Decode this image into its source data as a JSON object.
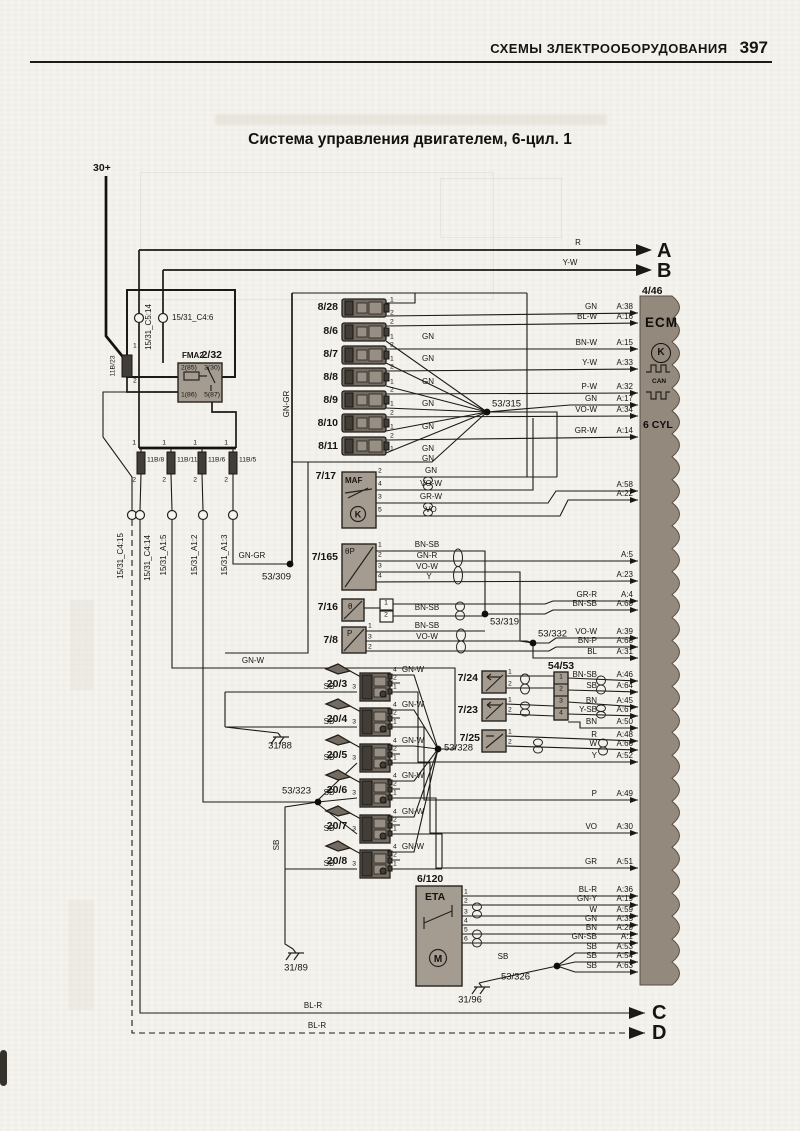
{
  "page": {
    "header": "СХЕМЫ ЗЛЕКТРООБОРУДОВАНИЯ",
    "page_number": "397",
    "title": "Система управления двигателем, 6-цил. 1"
  },
  "ecm": {
    "code": "4/46",
    "name": "ECM",
    "k": "K",
    "can": "CAN",
    "cyl": "6 CYL",
    "m": "M"
  },
  "ecm_rows": [
    {
      "w": "GN",
      "p": "A:38",
      "y": 313
    },
    {
      "w": "BL-W",
      "p": "A:16",
      "y": 323
    },
    {
      "w": "BN-W",
      "p": "A:15",
      "y": 349
    },
    {
      "w": "Y-W",
      "p": "A:33",
      "y": 369
    },
    {
      "w": "P-W",
      "p": "A:32",
      "y": 393
    },
    {
      "w": "GN",
      "p": "A:17",
      "y": 405
    },
    {
      "w": "VO-W",
      "p": "A:34",
      "y": 416
    },
    {
      "w": "GR-W",
      "p": "A:14",
      "y": 437
    },
    {
      "w": "",
      "p": "A:58",
      "y": 491
    },
    {
      "w": "",
      "p": "A:22",
      "y": 500
    },
    {
      "w": "",
      "p": "A:5",
      "y": 561
    },
    {
      "w": "",
      "p": "A:23",
      "y": 581
    },
    {
      "w": "GR-R",
      "p": "A:4",
      "y": 601
    },
    {
      "w": "BN-SB",
      "p": "A:60",
      "y": 610
    },
    {
      "w": "VO-W",
      "p": "A:39",
      "y": 638
    },
    {
      "w": "BN-P",
      "p": "A:68",
      "y": 647
    },
    {
      "w": "BL",
      "p": "A:31",
      "y": 658
    },
    {
      "w": "BN-SB",
      "p": "A:46",
      "y": 681
    },
    {
      "w": "SB",
      "p": "A:64",
      "y": 692
    },
    {
      "w": "BN",
      "p": "A:45",
      "y": 707
    },
    {
      "w": "Y-SB",
      "p": "A:67",
      "y": 716
    },
    {
      "w": "BN",
      "p": "A:50",
      "y": 728
    },
    {
      "w": "R",
      "p": "A:48",
      "y": 741
    },
    {
      "w": "W",
      "p": "A:66",
      "y": 750
    },
    {
      "w": "Y",
      "p": "A:52",
      "y": 762
    },
    {
      "w": "P",
      "p": "A:49",
      "y": 800
    },
    {
      "w": "VO",
      "p": "A:30",
      "y": 833
    },
    {
      "w": "GR",
      "p": "A:51",
      "y": 868
    },
    {
      "w": "BL-R",
      "p": "A:36",
      "y": 896
    },
    {
      "w": "GN-Y",
      "p": "A:19",
      "y": 905
    },
    {
      "w": "W",
      "p": "A:59",
      "y": 916
    },
    {
      "w": "GN",
      "p": "A:35",
      "y": 925
    },
    {
      "w": "BN",
      "p": "A:20",
      "y": 934
    },
    {
      "w": "GN-SB",
      "p": "A:1",
      "y": 943
    },
    {
      "w": "SB",
      "p": "A:53",
      "y": 953
    },
    {
      "w": "SB",
      "p": "A:54",
      "y": 962
    },
    {
      "w": "SB",
      "p": "A:63",
      "y": 972
    }
  ],
  "labels": [
    {
      "t": "30+",
      "x": 93,
      "y": 168,
      "c": "b"
    },
    {
      "t": "15/31_C5:14",
      "x": 149,
      "y": 327,
      "c": "v s"
    },
    {
      "t": "15/31_C4:6",
      "x": 172,
      "y": 318,
      "c": "s"
    },
    {
      "t": "FMA2",
      "x": 182,
      "y": 356,
      "c": "b s"
    },
    {
      "t": "2/32",
      "x": 222,
      "y": 355,
      "c": "r b"
    },
    {
      "t": "2(85)",
      "x": 181,
      "y": 369,
      "c": "ss"
    },
    {
      "t": "3(30)",
      "x": 220,
      "y": 369,
      "c": "r ss"
    },
    {
      "t": "1(86)",
      "x": 181,
      "y": 396,
      "c": "ss"
    },
    {
      "t": "5(87)",
      "x": 220,
      "y": 396,
      "c": "r ss"
    },
    {
      "t": "11B/23",
      "x": 114,
      "y": 366,
      "c": "v ss"
    },
    {
      "t": "1",
      "x": 133,
      "y": 347,
      "c": "ss"
    },
    {
      "t": "2",
      "x": 133,
      "y": 382,
      "c": "ss"
    },
    {
      "t": "1",
      "x": 136,
      "y": 444,
      "c": "r ss"
    },
    {
      "t": "1",
      "x": 166,
      "y": 444,
      "c": "r ss"
    },
    {
      "t": "1",
      "x": 197,
      "y": 444,
      "c": "r ss"
    },
    {
      "t": "1",
      "x": 228,
      "y": 444,
      "c": "r ss"
    },
    {
      "t": "11B/8",
      "x": 147,
      "y": 461,
      "c": "ss"
    },
    {
      "t": "11B/11",
      "x": 177,
      "y": 461,
      "c": "ss"
    },
    {
      "t": "11B/6",
      "x": 208,
      "y": 461,
      "c": "ss"
    },
    {
      "t": "11B/5",
      "x": 239,
      "y": 461,
      "c": "ss"
    },
    {
      "t": "2",
      "x": 136,
      "y": 481,
      "c": "r ss"
    },
    {
      "t": "2",
      "x": 166,
      "y": 481,
      "c": "r ss"
    },
    {
      "t": "2",
      "x": 197,
      "y": 481,
      "c": "r ss"
    },
    {
      "t": "2",
      "x": 228,
      "y": 481,
      "c": "r ss"
    },
    {
      "t": "15/31_C4:15",
      "x": 121,
      "y": 556,
      "c": "v s"
    },
    {
      "t": "15/31_C4:14",
      "x": 148,
      "y": 558,
      "c": "v s"
    },
    {
      "t": "15/31_A1:5",
      "x": 164,
      "y": 555,
      "c": "v s"
    },
    {
      "t": "15/31_A1:2",
      "x": 195,
      "y": 555,
      "c": "v s"
    },
    {
      "t": "15/31_A1:3",
      "x": 225,
      "y": 555,
      "c": "v s"
    },
    {
      "t": "GN-GR",
      "x": 287,
      "y": 404,
      "c": "v s"
    },
    {
      "t": "GN-GR",
      "x": 252,
      "y": 556,
      "c": "c s"
    },
    {
      "t": "53/309",
      "x": 291,
      "y": 577,
      "c": "r"
    },
    {
      "t": "GN-W",
      "x": 253,
      "y": 661,
      "c": "c s"
    },
    {
      "t": "SB",
      "x": 277,
      "y": 845,
      "c": "v s"
    },
    {
      "t": "31/88",
      "x": 280,
      "y": 746,
      "c": "c"
    },
    {
      "t": "31/89",
      "x": 296,
      "y": 968,
      "c": "c"
    },
    {
      "t": "31/96",
      "x": 470,
      "y": 1000,
      "c": "c"
    },
    {
      "t": "8/28",
      "x": 338,
      "y": 307,
      "c": "r b"
    },
    {
      "t": "8/6",
      "x": 338,
      "y": 331,
      "c": "r b"
    },
    {
      "t": "8/7",
      "x": 338,
      "y": 354,
      "c": "r b"
    },
    {
      "t": "8/8",
      "x": 338,
      "y": 377,
      "c": "r b"
    },
    {
      "t": "8/9",
      "x": 338,
      "y": 400,
      "c": "r b"
    },
    {
      "t": "8/10",
      "x": 338,
      "y": 423,
      "c": "r b"
    },
    {
      "t": "8/11",
      "x": 338,
      "y": 446,
      "c": "r b"
    },
    {
      "t": "1",
      "x": 390,
      "y": 301,
      "c": "ss"
    },
    {
      "t": "2",
      "x": 390,
      "y": 314,
      "c": "ss"
    },
    {
      "t": "2",
      "x": 390,
      "y": 323,
      "c": "ss"
    },
    {
      "t": "1",
      "x": 390,
      "y": 338,
      "c": "ss"
    },
    {
      "t": "2",
      "x": 390,
      "y": 346,
      "c": "ss"
    },
    {
      "t": "1",
      "x": 390,
      "y": 360,
      "c": "ss"
    },
    {
      "t": "2",
      "x": 390,
      "y": 368,
      "c": "ss"
    },
    {
      "t": "1",
      "x": 390,
      "y": 383,
      "c": "ss"
    },
    {
      "t": "2",
      "x": 390,
      "y": 391,
      "c": "ss"
    },
    {
      "t": "1",
      "x": 390,
      "y": 405,
      "c": "ss"
    },
    {
      "t": "2",
      "x": 390,
      "y": 414,
      "c": "ss"
    },
    {
      "t": "1",
      "x": 390,
      "y": 428,
      "c": "ss"
    },
    {
      "t": "2",
      "x": 390,
      "y": 437,
      "c": "ss"
    },
    {
      "t": "1",
      "x": 390,
      "y": 450,
      "c": "ss"
    },
    {
      "t": "GN",
      "x": 428,
      "y": 337,
      "c": "c s"
    },
    {
      "t": "GN",
      "x": 428,
      "y": 359,
      "c": "c s"
    },
    {
      "t": "GN",
      "x": 428,
      "y": 382,
      "c": "c s"
    },
    {
      "t": "GN",
      "x": 428,
      "y": 404,
      "c": "c s"
    },
    {
      "t": "GN",
      "x": 428,
      "y": 427,
      "c": "c s"
    },
    {
      "t": "GN",
      "x": 428,
      "y": 449,
      "c": "c s"
    },
    {
      "t": "GN",
      "x": 428,
      "y": 459,
      "c": "c s"
    },
    {
      "t": "53/315",
      "x": 492,
      "y": 404
    },
    {
      "t": "7/17",
      "x": 336,
      "y": 476,
      "c": "r b"
    },
    {
      "t": "MAF",
      "x": 345,
      "y": 481,
      "c": "b s"
    },
    {
      "t": "2",
      "x": 378,
      "y": 472,
      "c": "ss"
    },
    {
      "t": "4",
      "x": 378,
      "y": 485,
      "c": "ss"
    },
    {
      "t": "3",
      "x": 378,
      "y": 498,
      "c": "ss"
    },
    {
      "t": "5",
      "x": 378,
      "y": 511,
      "c": "ss"
    },
    {
      "t": "GN",
      "x": 431,
      "y": 471,
      "c": "c s"
    },
    {
      "t": "VO-W",
      "x": 431,
      "y": 484,
      "c": "c s"
    },
    {
      "t": "GR-W",
      "x": 431,
      "y": 497,
      "c": "c s"
    },
    {
      "t": "VO",
      "x": 431,
      "y": 510,
      "c": "c s"
    },
    {
      "t": "7/165",
      "x": 338,
      "y": 557,
      "c": "r b"
    },
    {
      "t": "θP",
      "x": 345,
      "y": 552,
      "c": "s"
    },
    {
      "t": "1",
      "x": 378,
      "y": 546,
      "c": "ss"
    },
    {
      "t": "2",
      "x": 378,
      "y": 556,
      "c": "ss"
    },
    {
      "t": "3",
      "x": 378,
      "y": 567,
      "c": "ss"
    },
    {
      "t": "4",
      "x": 378,
      "y": 577,
      "c": "ss"
    },
    {
      "t": "BN-SB",
      "x": 427,
      "y": 545,
      "c": "c s"
    },
    {
      "t": "GN-R",
      "x": 427,
      "y": 556,
      "c": "c s"
    },
    {
      "t": "VO-W",
      "x": 427,
      "y": 567,
      "c": "c s"
    },
    {
      "t": "Y",
      "x": 429,
      "y": 577,
      "c": "c s"
    },
    {
      "t": "7/16",
      "x": 338,
      "y": 607,
      "c": "r b"
    },
    {
      "t": "θ",
      "x": 348,
      "y": 607,
      "c": "s"
    },
    {
      "t": "1",
      "x": 386,
      "y": 604,
      "c": "c ss"
    },
    {
      "t": "2",
      "x": 386,
      "y": 616,
      "c": "c ss"
    },
    {
      "t": "BN-SB",
      "x": 427,
      "y": 608,
      "c": "c s"
    },
    {
      "t": "7/8",
      "x": 338,
      "y": 640,
      "c": "r b"
    },
    {
      "t": "P",
      "x": 347,
      "y": 634,
      "c": "s"
    },
    {
      "t": "1",
      "x": 368,
      "y": 627,
      "c": "ss"
    },
    {
      "t": "3",
      "x": 368,
      "y": 638,
      "c": "ss"
    },
    {
      "t": "2",
      "x": 368,
      "y": 648,
      "c": "ss"
    },
    {
      "t": "BN-SB",
      "x": 427,
      "y": 626,
      "c": "c s"
    },
    {
      "t": "VO-W",
      "x": 427,
      "y": 637,
      "c": "c s"
    },
    {
      "t": "53/319",
      "x": 490,
      "y": 622
    },
    {
      "t": "53/332",
      "x": 538,
      "y": 634
    },
    {
      "t": "53/328",
      "x": 444,
      "y": 748
    },
    {
      "t": "53/323",
      "x": 311,
      "y": 791,
      "c": "r"
    },
    {
      "t": "20/3",
      "x": 337,
      "y": 684,
      "c": "c b"
    },
    {
      "t": "20/4",
      "x": 337,
      "y": 719,
      "c": "c b"
    },
    {
      "t": "20/5",
      "x": 337,
      "y": 755,
      "c": "c b"
    },
    {
      "t": "20/6",
      "x": 337,
      "y": 790,
      "c": "c b"
    },
    {
      "t": "20/7",
      "x": 337,
      "y": 826,
      "c": "c b"
    },
    {
      "t": "20/8",
      "x": 337,
      "y": 861,
      "c": "c b"
    },
    {
      "t": "SB",
      "x": 329,
      "y": 687,
      "c": "c s"
    },
    {
      "t": "SB",
      "x": 329,
      "y": 722,
      "c": "c s"
    },
    {
      "t": "SB",
      "x": 329,
      "y": 758,
      "c": "c s"
    },
    {
      "t": "SB",
      "x": 329,
      "y": 793,
      "c": "c s"
    },
    {
      "t": "SB",
      "x": 329,
      "y": 829,
      "c": "c s"
    },
    {
      "t": "SB",
      "x": 329,
      "y": 864,
      "c": "c s"
    },
    {
      "t": "3",
      "x": 356,
      "y": 688,
      "c": "r ss"
    },
    {
      "t": "3",
      "x": 356,
      "y": 723,
      "c": "r ss"
    },
    {
      "t": "3",
      "x": 356,
      "y": 759,
      "c": "r ss"
    },
    {
      "t": "3",
      "x": 356,
      "y": 794,
      "c": "r ss"
    },
    {
      "t": "3",
      "x": 356,
      "y": 830,
      "c": "r ss"
    },
    {
      "t": "3",
      "x": 356,
      "y": 865,
      "c": "r ss"
    },
    {
      "t": "4",
      "x": 393,
      "y": 671,
      "c": "ss"
    },
    {
      "t": "4",
      "x": 393,
      "y": 706,
      "c": "ss"
    },
    {
      "t": "4",
      "x": 393,
      "y": 742,
      "c": "ss"
    },
    {
      "t": "4",
      "x": 393,
      "y": 777,
      "c": "ss"
    },
    {
      "t": "4",
      "x": 393,
      "y": 813,
      "c": "ss"
    },
    {
      "t": "4",
      "x": 393,
      "y": 848,
      "c": "ss"
    },
    {
      "t": "2",
      "x": 393,
      "y": 679,
      "c": "ss"
    },
    {
      "t": "2",
      "x": 393,
      "y": 714,
      "c": "ss"
    },
    {
      "t": "2",
      "x": 393,
      "y": 750,
      "c": "ss"
    },
    {
      "t": "2",
      "x": 393,
      "y": 785,
      "c": "ss"
    },
    {
      "t": "2",
      "x": 393,
      "y": 821,
      "c": "ss"
    },
    {
      "t": "2",
      "x": 393,
      "y": 856,
      "c": "ss"
    },
    {
      "t": "1",
      "x": 393,
      "y": 688,
      "c": "ss"
    },
    {
      "t": "1",
      "x": 393,
      "y": 723,
      "c": "ss"
    },
    {
      "t": "1",
      "x": 393,
      "y": 759,
      "c": "ss"
    },
    {
      "t": "1",
      "x": 393,
      "y": 794,
      "c": "ss"
    },
    {
      "t": "1",
      "x": 393,
      "y": 830,
      "c": "ss"
    },
    {
      "t": "1",
      "x": 393,
      "y": 865,
      "c": "ss"
    },
    {
      "t": "GN-W",
      "x": 413,
      "y": 670,
      "c": "c s"
    },
    {
      "t": "GN-W",
      "x": 413,
      "y": 705,
      "c": "c s"
    },
    {
      "t": "GN-W",
      "x": 413,
      "y": 741,
      "c": "c s"
    },
    {
      "t": "GN-W",
      "x": 413,
      "y": 776,
      "c": "c s"
    },
    {
      "t": "GN-W",
      "x": 413,
      "y": 812,
      "c": "c s"
    },
    {
      "t": "GN-W",
      "x": 413,
      "y": 847,
      "c": "c s"
    },
    {
      "t": "7/24",
      "x": 478,
      "y": 678,
      "c": "r b"
    },
    {
      "t": "7/23",
      "x": 478,
      "y": 710,
      "c": "r b"
    },
    {
      "t": "7/25",
      "x": 480,
      "y": 738,
      "c": "r b"
    },
    {
      "t": "54/53",
      "x": 561,
      "y": 666,
      "c": "c b"
    },
    {
      "t": "1",
      "x": 561,
      "y": 678,
      "c": "c ss"
    },
    {
      "t": "2",
      "x": 561,
      "y": 690,
      "c": "c ss"
    },
    {
      "t": "3",
      "x": 561,
      "y": 702,
      "c": "c ss"
    },
    {
      "t": "4",
      "x": 561,
      "y": 714,
      "c": "c ss"
    },
    {
      "t": "1",
      "x": 508,
      "y": 673,
      "c": "ss"
    },
    {
      "t": "2",
      "x": 508,
      "y": 685,
      "c": "ss"
    },
    {
      "t": "1",
      "x": 508,
      "y": 701,
      "c": "ss"
    },
    {
      "t": "2",
      "x": 508,
      "y": 711,
      "c": "ss"
    },
    {
      "t": "1",
      "x": 508,
      "y": 733,
      "c": "ss"
    },
    {
      "t": "2",
      "x": 508,
      "y": 743,
      "c": "ss"
    },
    {
      "t": "6/120",
      "x": 417,
      "y": 879,
      "c": "b"
    },
    {
      "t": "ETA",
      "x": 425,
      "y": 897,
      "c": "b"
    },
    {
      "t": "1",
      "x": 464,
      "y": 893,
      "c": "ss"
    },
    {
      "t": "2",
      "x": 464,
      "y": 902,
      "c": "ss"
    },
    {
      "t": "3",
      "x": 464,
      "y": 913,
      "c": "ss"
    },
    {
      "t": "4",
      "x": 464,
      "y": 922,
      "c": "ss"
    },
    {
      "t": "5",
      "x": 464,
      "y": 931,
      "c": "ss"
    },
    {
      "t": "6",
      "x": 464,
      "y": 940,
      "c": "ss"
    },
    {
      "t": "SB",
      "x": 503,
      "y": 957,
      "c": "c s"
    },
    {
      "t": "53/326",
      "x": 530,
      "y": 977,
      "c": "r"
    },
    {
      "t": "BL-R",
      "x": 313,
      "y": 1006,
      "c": "c s"
    },
    {
      "t": "BL-R",
      "x": 317,
      "y": 1026,
      "c": "c s"
    },
    {
      "t": "R",
      "x": 578,
      "y": 243,
      "c": "c s"
    },
    {
      "t": "Y-W",
      "x": 570,
      "y": 263,
      "c": "c s"
    },
    {
      "t": "A",
      "x": 657,
      "y": 251,
      "c": "big"
    },
    {
      "t": "B",
      "x": 657,
      "y": 271,
      "c": "big"
    },
    {
      "t": "C",
      "x": 652,
      "y": 1013,
      "c": "big"
    },
    {
      "t": "D",
      "x": 652,
      "y": 1033,
      "c": "big"
    }
  ]
}
